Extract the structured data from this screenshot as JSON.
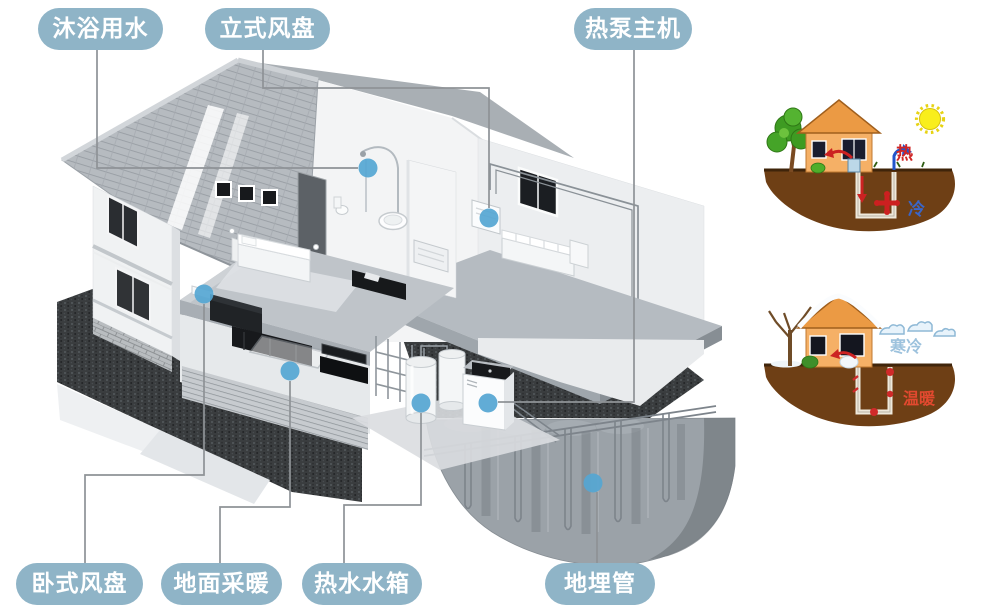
{
  "labels": {
    "bathing_water": "沐浴用水",
    "vertical_fan_coil": "立式风盘",
    "heat_pump_unit": "热泵主机",
    "horizontal_fan_coil": "卧式风盘",
    "floor_heating": "地面采暖",
    "hot_water_tank": "热水水箱",
    "buried_pipe": "地埋管"
  },
  "seasonal": {
    "summer": {
      "hot": "热",
      "cold": "冷"
    },
    "winter": {
      "cold": "寒冷",
      "warm": "温暖"
    }
  },
  "colors": {
    "label_bg": "#8fb4c7",
    "label_text": "#ffffff",
    "leader_line": "#8e9296",
    "marker_dot": "#55a6d3",
    "summer_hot_text": "#cf2525",
    "summer_cold_text": "#3a66c9",
    "winter_cold_text": "#9dc2dd",
    "winter_warm_text": "#e2492f",
    "soil_brown": "#6e3f15"
  },
  "icons": {
    "sun": "sun-icon",
    "snow_clouds": "snow-clouds-icon",
    "marker": "marker-dot"
  }
}
